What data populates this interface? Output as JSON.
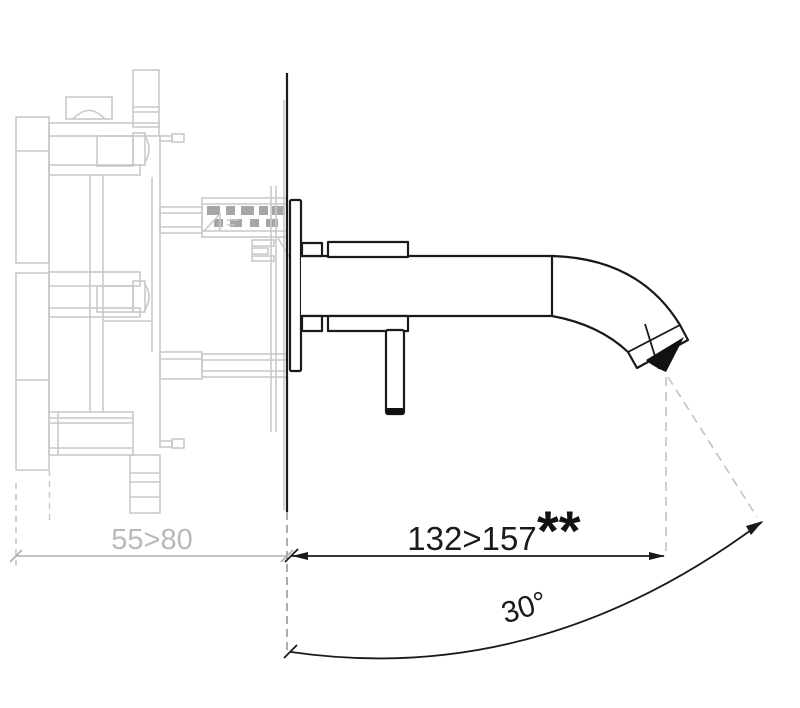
{
  "diagram": {
    "kind": "technical-installation-drawing",
    "dimensions": {
      "wall_depth_label": "55>80",
      "spout_reach_label": "132>157",
      "spout_reach_note": "**",
      "swivel_angle_label": "30°"
    },
    "colors": {
      "ink": "#1a1a1a",
      "ghost_gray": "#c9c9c9",
      "muted_gray": "#b0b0b0",
      "outlet_black": "#111111",
      "background": "#ffffff"
    }
  }
}
